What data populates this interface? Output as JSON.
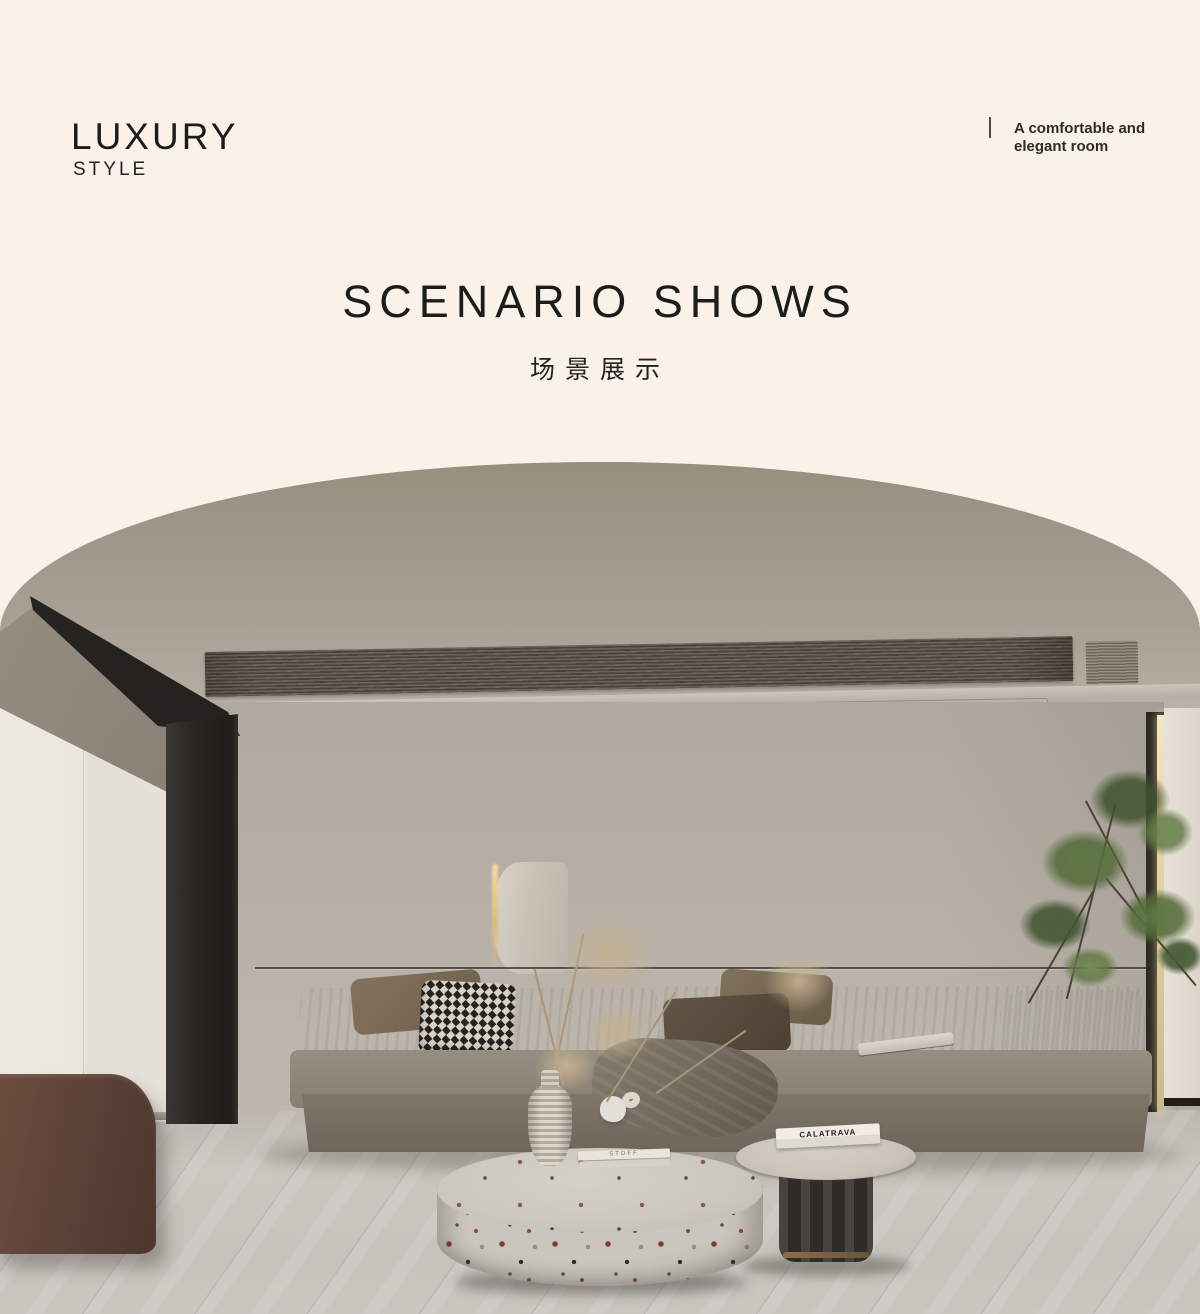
{
  "header": {
    "brand_title": "LUXURY",
    "brand_subtitle": "STYLE",
    "tagline_line1": "A comfortable and",
    "tagline_line2": "elegant room"
  },
  "section": {
    "title": "SCENARIO SHOWS",
    "subtitle_zh": "场景展示"
  },
  "scene": {
    "side_table_book_title": "CALATRAVA",
    "coffee_table_book_title": "STOFF",
    "colors": {
      "page_background": "#faf2e8",
      "heading_text": "#1c1c1c",
      "ceiling": "#a29a8e",
      "wall": "#b7b0a7",
      "sofa": "#8a8276",
      "floor": "#c7c3bc",
      "bench_leather": "#5d4338",
      "column_black": "#26231f",
      "led_glow": "#eadfbf",
      "plant_green": "#55703f",
      "terrazzo": "#cbc6bd"
    }
  }
}
